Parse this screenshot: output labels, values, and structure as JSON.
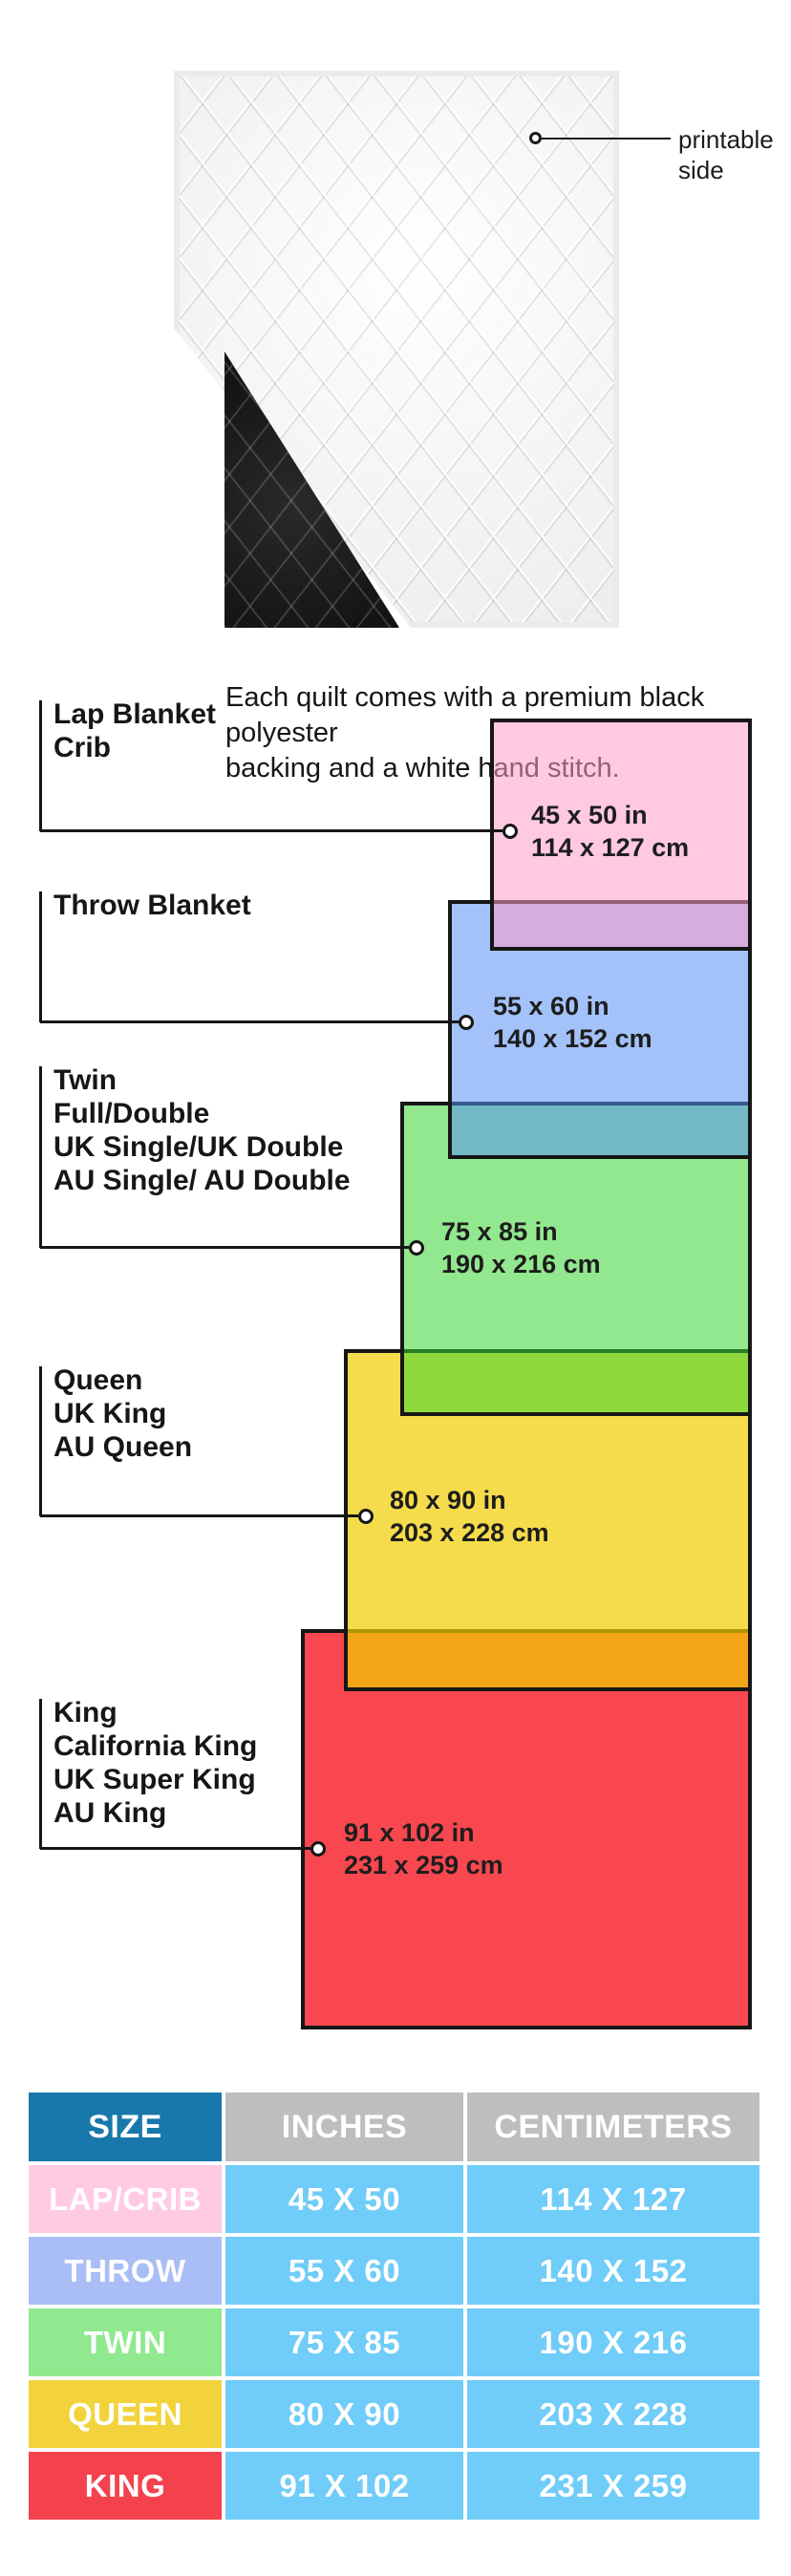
{
  "quilt": {
    "printable_lines": [
      "printable",
      "side"
    ],
    "caption_lines": [
      "Each quilt comes with a premium black polyester",
      "backing and a white hand stitch."
    ]
  },
  "diagram": {
    "sizes": [
      {
        "id": "lap",
        "label_lines": [
          "Lap Blanket",
          "Crib"
        ],
        "dim_in": "45 x 50 in",
        "dim_cm": "114 x 127 cm",
        "fill": "rgba(255,157,203,0.55)"
      },
      {
        "id": "throw",
        "label_lines": [
          "Throw Blanket"
        ],
        "dim_in": "55 x 60 in",
        "dim_cm": "140 x 152 cm",
        "fill": "rgba(88,144,245,0.55)"
      },
      {
        "id": "twin",
        "label_lines": [
          "Twin",
          "Full/Double",
          "UK Single/UK Double",
          "AU Single/ AU Double"
        ],
        "dim_in": "75 x 85 in",
        "dim_cm": "190 x 216 cm",
        "fill": "rgba(57,213,50,0.55)"
      },
      {
        "id": "queen",
        "label_lines": [
          "Queen",
          "UK King",
          "AU Queen"
        ],
        "dim_in": "80 x 90 in",
        "dim_cm": "203 x 228 cm",
        "fill": "rgba(241,205,0,0.70)"
      },
      {
        "id": "king",
        "label_lines": [
          "King",
          "California King",
          "UK Super King",
          "AU King"
        ],
        "dim_in": "91 x 102 in",
        "dim_cm": "231 x 259 cm",
        "fill": "#F8474F"
      }
    ],
    "line_color": "#161616"
  },
  "table": {
    "headers": [
      "SIZE",
      "INCHES",
      "CENTIMETERS"
    ],
    "header_size_bg": "#1878AC",
    "header_other_bg": "#BEBEBE",
    "data_cell_bg": "#70CCF8",
    "rows": [
      {
        "size": "LAP/CRIB",
        "inches": "45 X 50",
        "cm": "114 X 127",
        "color": "#FFCBE3"
      },
      {
        "size": "THROW",
        "inches": "55 X 60",
        "cm": "140 X 152",
        "color": "#A9BDF6"
      },
      {
        "size": "TWIN",
        "inches": "75 X 85",
        "cm": "190 X 216",
        "color": "#90E98F"
      },
      {
        "size": "QUEEN",
        "inches": "80 X 90",
        "cm": "203 X 228",
        "color": "#F3D33C"
      },
      {
        "size": "KING",
        "inches": "91 X 102",
        "cm": "231 X 259",
        "color": "#F3424E"
      }
    ]
  }
}
